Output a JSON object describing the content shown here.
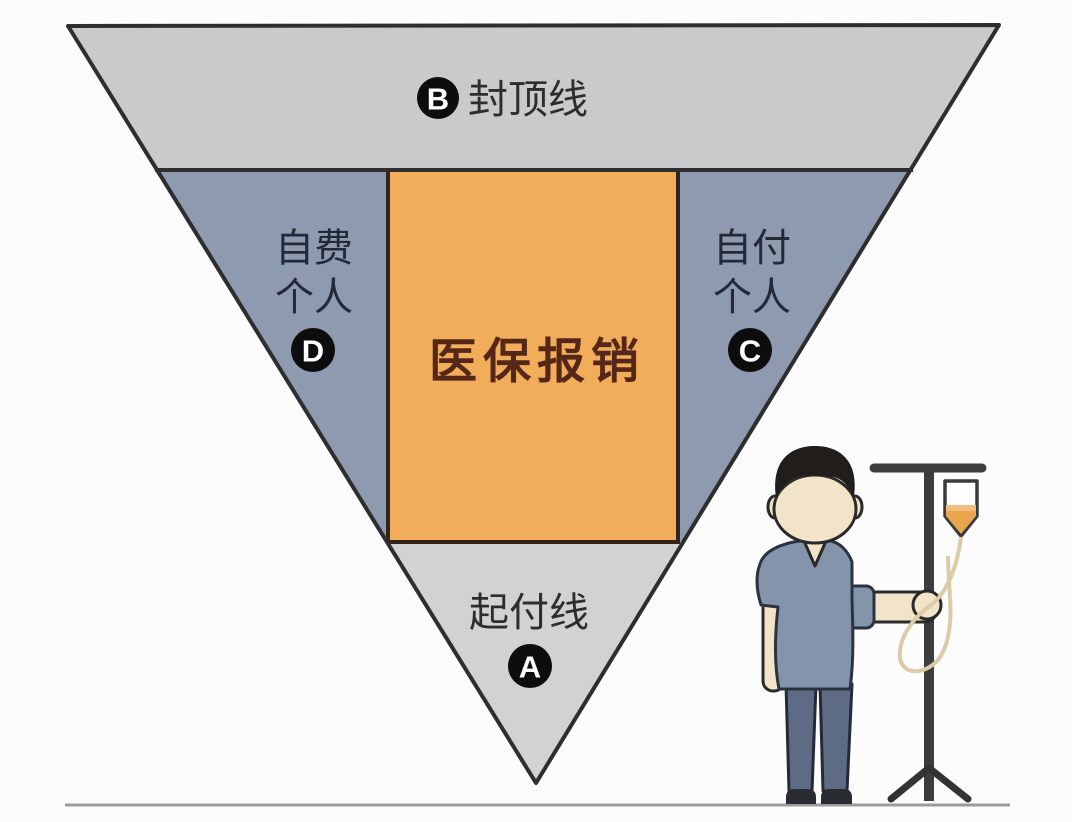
{
  "diagram": {
    "title": "医保报销结构倒三角示意图",
    "top_region": {
      "badge": "B",
      "label": "封顶线"
    },
    "left_region": {
      "line1": "自费",
      "line2": "个人",
      "badge": "D"
    },
    "center_region": {
      "label": "医保报销"
    },
    "right_region": {
      "line1": "自付",
      "line2": "个人",
      "badge": "C"
    },
    "bottom_region": {
      "badge": "A",
      "label": "起付线"
    },
    "colors": {
      "top_band": "#cacacb",
      "side_band": "#8e9ab0",
      "center_box": "#f1ad59",
      "bottom_band": "#d2d2d2",
      "outline": "#2e2e2e",
      "center_box_border": "#33241a",
      "center_text": "#552718",
      "side_text": "#232936",
      "badge_background": "#0d0d0d",
      "badge_text": "#ffffff",
      "ground_line": "#9b9b9b",
      "iv_liquid": "#e9a64f"
    },
    "illustration": {
      "patient": "patient-cartoon-figure",
      "iv_stand": "iv-drip-stand"
    }
  }
}
